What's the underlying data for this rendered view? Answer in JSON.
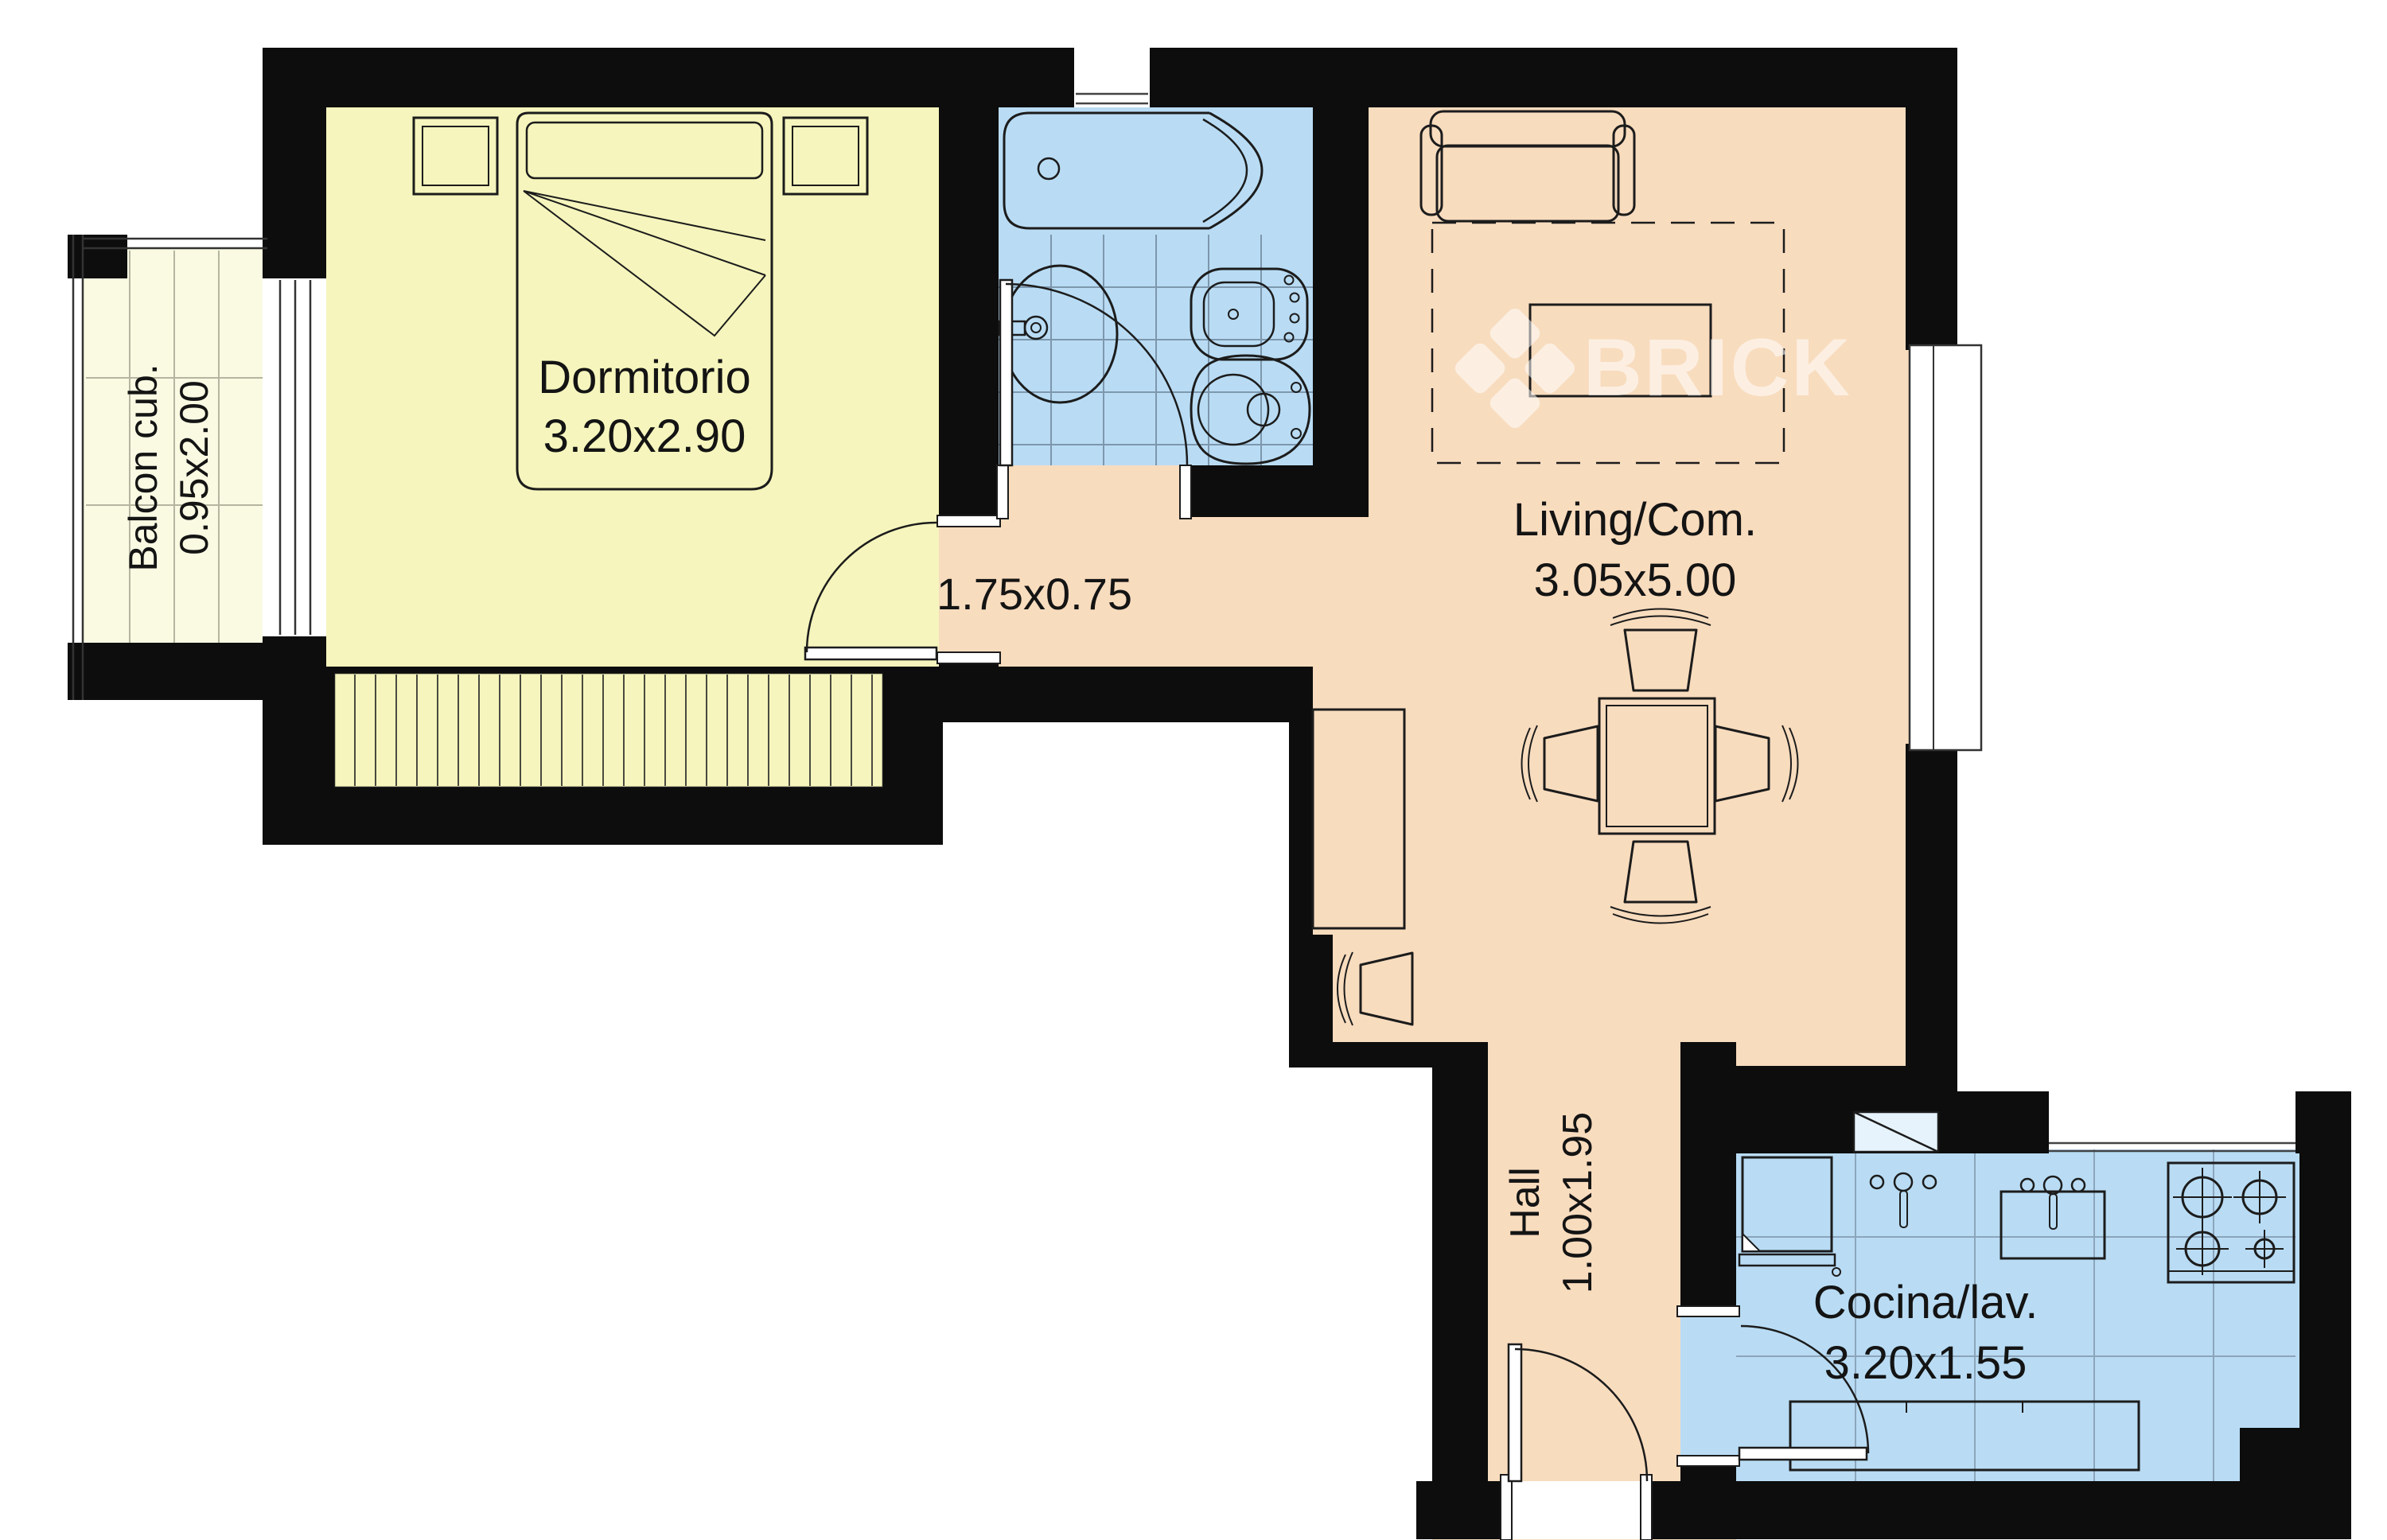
{
  "watermark": {
    "brand": "BRICK"
  },
  "rooms": {
    "dormitorio": {
      "label": "Dormitorio",
      "dims": "3.20x2.90"
    },
    "balcon": {
      "label": "Balcon cub.",
      "dims": "0.95x2.00"
    },
    "pasillo": {
      "dims": "1.75x0.75"
    },
    "living": {
      "label": "Living/Com.",
      "dims": "3.05x5.00"
    },
    "hall": {
      "label": "Hall",
      "dims": "1.00x1.95"
    },
    "cocina": {
      "label": "Cocina/lav.",
      "dims": "3.20x1.55"
    }
  },
  "colors": {
    "wall": "#0d0d0d",
    "bedroom": "#f5f5bd",
    "balcony": "#fafae3",
    "wet": "#b9dcf4",
    "living": "#f8dcbe",
    "outline": "#1c1c1c",
    "tile": "#7d97ad",
    "kitchen_tile": "#8ba5bb",
    "shaft": "#e6f3fc",
    "watermark": "#ffffff"
  }
}
